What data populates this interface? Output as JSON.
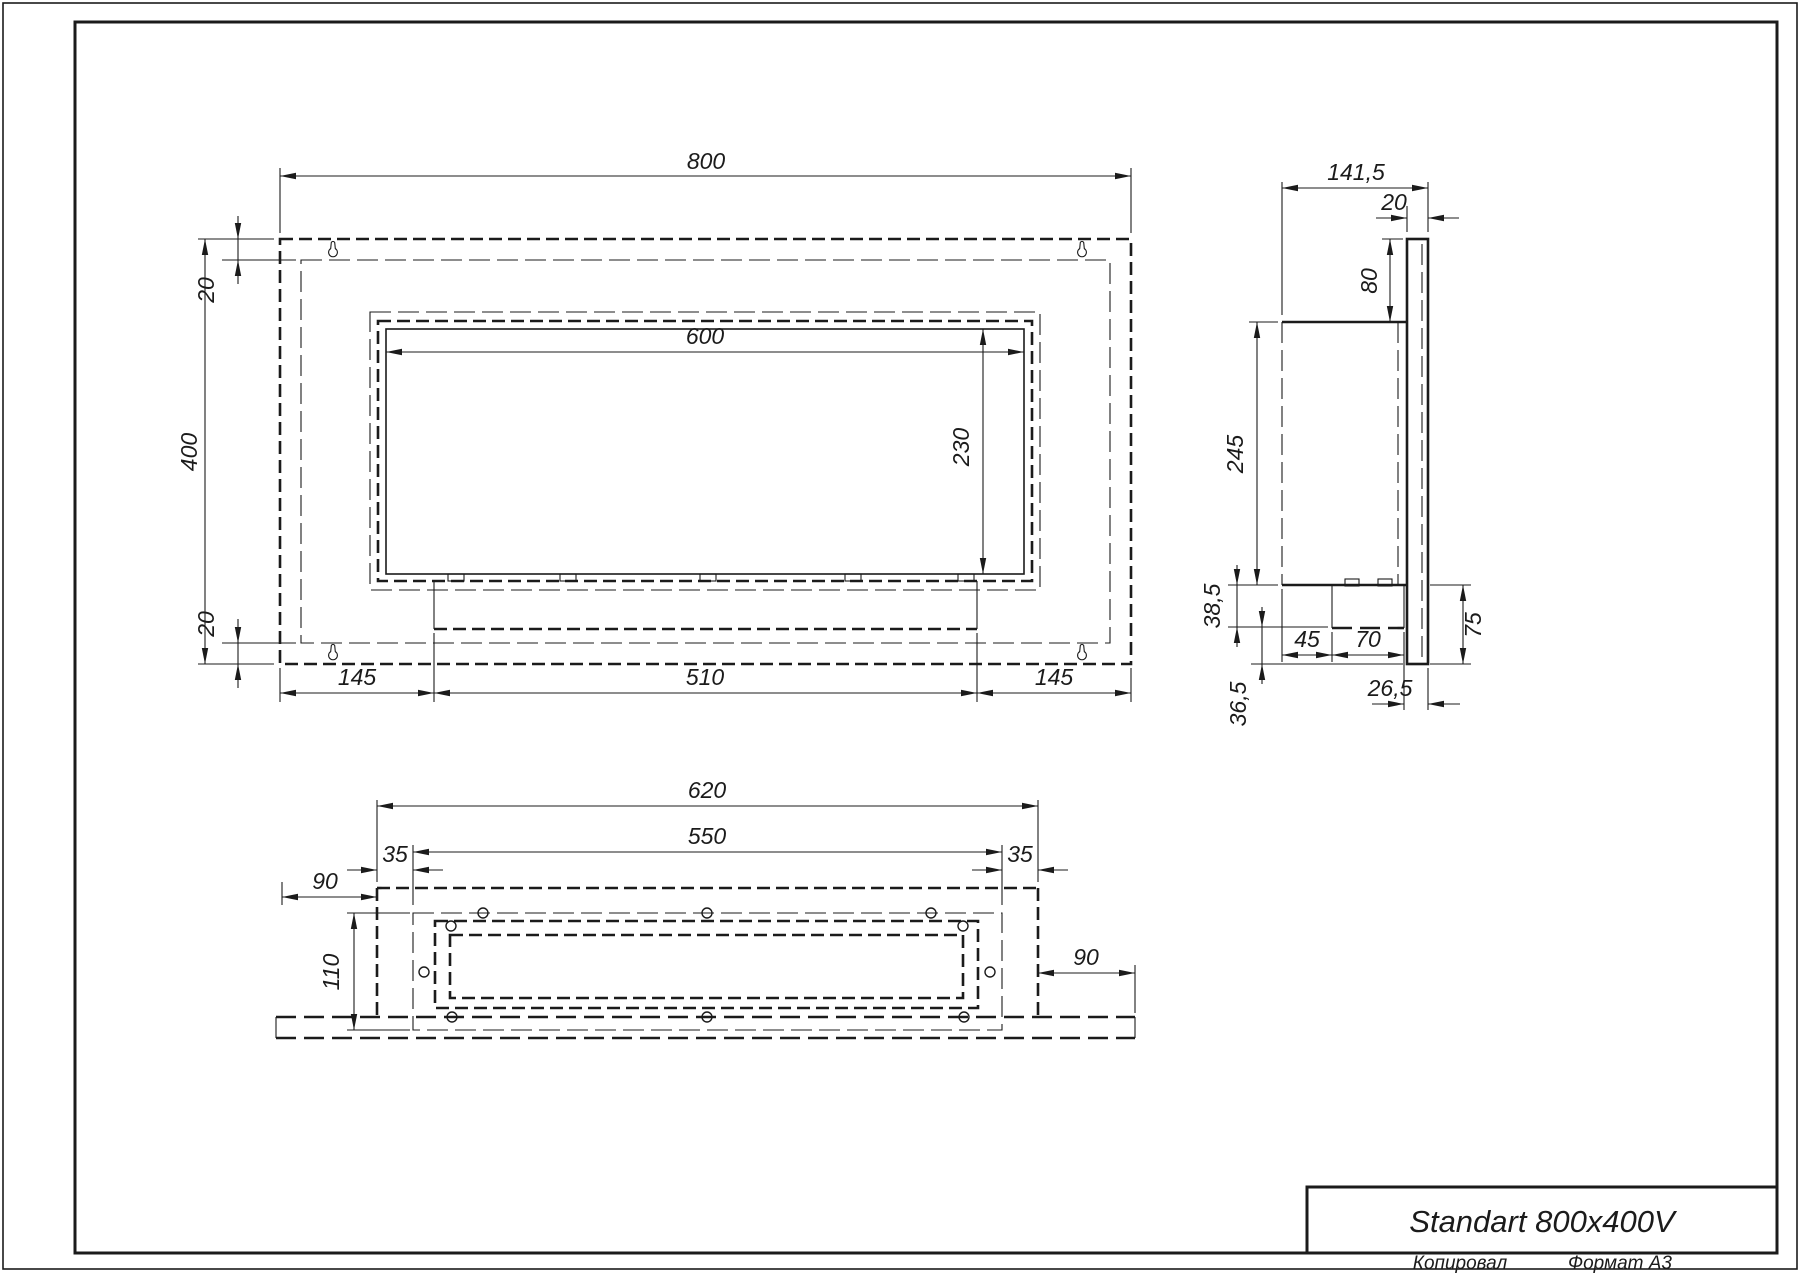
{
  "title_block": {
    "title": "Standart 800x400V"
  },
  "sheet": {
    "copied_label": "Копировал",
    "format_label": "Формат A3"
  },
  "views": {
    "front": {
      "overall_width": "800",
      "overall_height": "400",
      "frame_top": "20",
      "frame_bottom": "20",
      "opening_width": "600",
      "opening_height": "230",
      "tray_left": "145",
      "tray_width": "510",
      "tray_right": "145"
    },
    "side": {
      "overall_depth": "141,5",
      "panel_thickness": "20",
      "top_offset": "80",
      "housing_height": "245",
      "tray_height": "38,5",
      "bottom_offset": "36,5",
      "tray_front_offset": "45",
      "tray_depth": "70",
      "rear_gap": "26,5",
      "lower_assembly_height": "75"
    },
    "bottom": {
      "housing_width": "620",
      "slot_width": "550",
      "slot_margin_left": "35",
      "slot_margin_right": "35",
      "panel_overhang_left": "90",
      "panel_overhang_right": "90",
      "housing_depth": "110"
    }
  },
  "colors": {
    "line": "#1b1b1b",
    "paper": "#ffffff"
  }
}
